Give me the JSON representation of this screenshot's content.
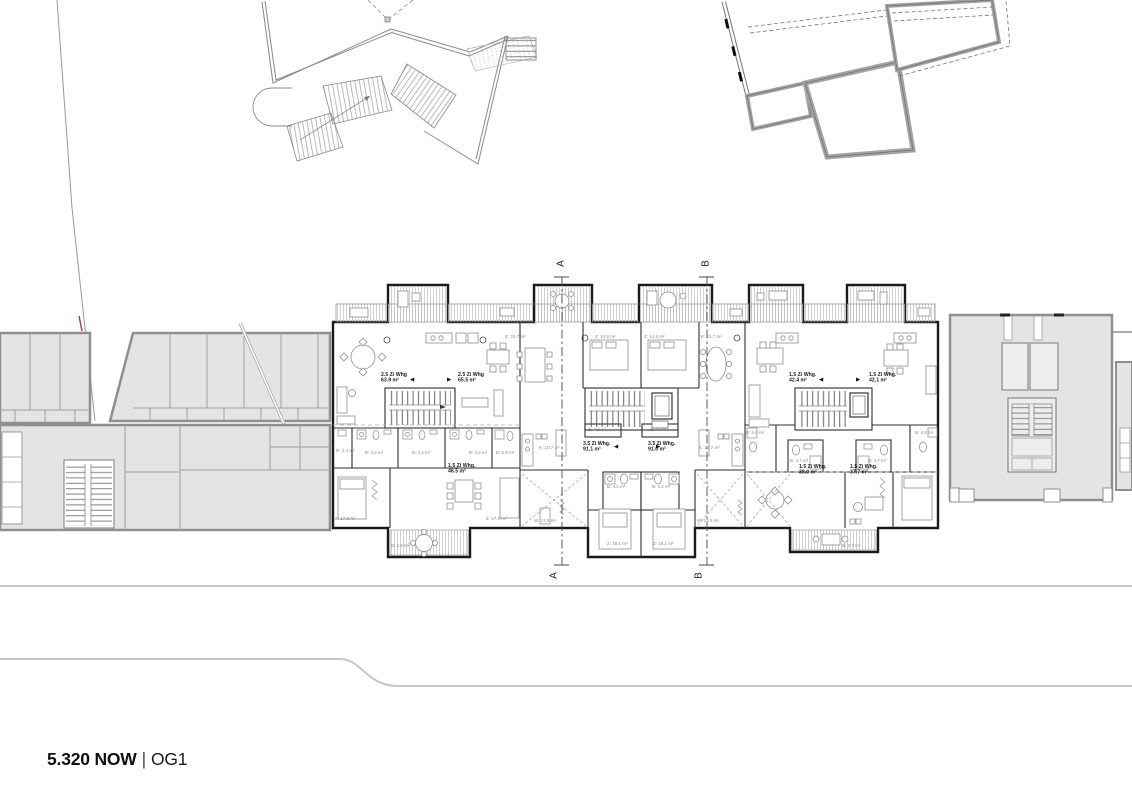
{
  "drawing": {
    "title": {
      "number": "5.320 NOW",
      "separator": "|",
      "level": "OG1"
    }
  },
  "apartments": [
    {
      "type": "2.5 Zi Whg",
      "area": "63.9 m²",
      "x": 381,
      "y": 372
    },
    {
      "type": "2.5 Zi Whg",
      "area": "65.5 m²",
      "x": 458,
      "y": 372
    },
    {
      "type": "3.5 Zi Whg.",
      "area": "91.1 m²",
      "x": 583,
      "y": 441
    },
    {
      "type": "3.5 Zi Whg.",
      "area": "91.0 m²",
      "x": 648,
      "y": 441
    },
    {
      "type": "1.5 Zi Whg.",
      "area": "42.4 m²",
      "x": 789,
      "y": 372
    },
    {
      "type": "1.5 Zi Whg.",
      "area": "42.1 m²",
      "x": 869,
      "y": 372
    },
    {
      "type": "1.5 Zi Whg.",
      "area": "46.5 m²",
      "x": 448,
      "y": 463
    },
    {
      "type": "1.5 Zi Whg.",
      "area": "38.0 m²",
      "x": 799,
      "y": 464
    },
    {
      "type": "1.5 Zi Whg.",
      "area": "37.7 m²",
      "x": 850,
      "y": 464
    }
  ],
  "room_labels": [
    {
      "text": "E: 21.7 m²",
      "x": 505,
      "y": 334
    },
    {
      "text": "Z: 14.6 m²",
      "x": 595,
      "y": 334
    },
    {
      "text": "Z: 14.6 m²",
      "x": 644,
      "y": 334
    },
    {
      "text": "E: 21.7 m²",
      "x": 701,
      "y": 334
    },
    {
      "text": "E: 4.1 m²",
      "x": 588,
      "y": 427
    },
    {
      "text": "E: 4.0 m²",
      "x": 650,
      "y": 427
    },
    {
      "text": "K: 10.7 m²",
      "x": 539,
      "y": 445
    },
    {
      "text": "K: 10.7 m²",
      "x": 699,
      "y": 445
    },
    {
      "text": "B: 4.2 m²",
      "x": 607,
      "y": 484
    },
    {
      "text": "B: 4.2 m²",
      "x": 652,
      "y": 484
    },
    {
      "text": "W: 12.5 m²",
      "x": 534,
      "y": 518
    },
    {
      "text": "W: 12.5 m²",
      "x": 697,
      "y": 518
    },
    {
      "text": "Z: 18.1 m²",
      "x": 607,
      "y": 541
    },
    {
      "text": "Z: 18.1 m²",
      "x": 653,
      "y": 541
    },
    {
      "text": "R: 4.3 m²",
      "x": 336,
      "y": 448
    },
    {
      "text": "B: 4.4 m²",
      "x": 365,
      "y": 450
    },
    {
      "text": "B: 4.4 m²",
      "x": 412,
      "y": 450
    },
    {
      "text": "B: 4.4 m²",
      "x": 469,
      "y": 450
    },
    {
      "text": "B: 5.8 m²",
      "x": 496,
      "y": 450
    },
    {
      "text": "Z: 17.9 m²",
      "x": 335,
      "y": 516
    },
    {
      "text": "Z: 17.9 m²",
      "x": 486,
      "y": 516
    },
    {
      "text": "B: 2.8 m²",
      "x": 391,
      "y": 543
    },
    {
      "text": "B: 5.0 m²",
      "x": 746,
      "y": 430
    },
    {
      "text": "B: 4.9 m²",
      "x": 915,
      "y": 430
    },
    {
      "text": "B: 4.7 m²",
      "x": 790,
      "y": 458
    },
    {
      "text": "B: 4.7 m²",
      "x": 868,
      "y": 458
    },
    {
      "text": "B: 2.7 m²",
      "x": 842,
      "y": 543
    }
  ],
  "entry_arrows": [
    {
      "glyph": "◀",
      "x": 410,
      "y": 376
    },
    {
      "glyph": "▶",
      "x": 447,
      "y": 376
    },
    {
      "glyph": "◀",
      "x": 614,
      "y": 443
    },
    {
      "glyph": "▶",
      "x": 656,
      "y": 443
    },
    {
      "glyph": "◀",
      "x": 819,
      "y": 376
    },
    {
      "glyph": "▶",
      "x": 856,
      "y": 376
    }
  ],
  "section_markers": [
    {
      "id": "A",
      "top": {
        "x": 555,
        "y": 258
      },
      "bottom": {
        "x": 548,
        "y": 570
      }
    },
    {
      "id": "B",
      "top": {
        "x": 700,
        "y": 258
      },
      "bottom": {
        "x": 693,
        "y": 570
      }
    }
  ],
  "colors": {
    "new_wall": "#1a1a1a",
    "existing_fill": "#e4e4e4",
    "existing_wall": "#8f8f8f",
    "deck_hatch": "#bcbcbc",
    "label_gray": "#8a8a8a",
    "site_line": "#c7c7c7",
    "accent_red": "#b0392f"
  }
}
